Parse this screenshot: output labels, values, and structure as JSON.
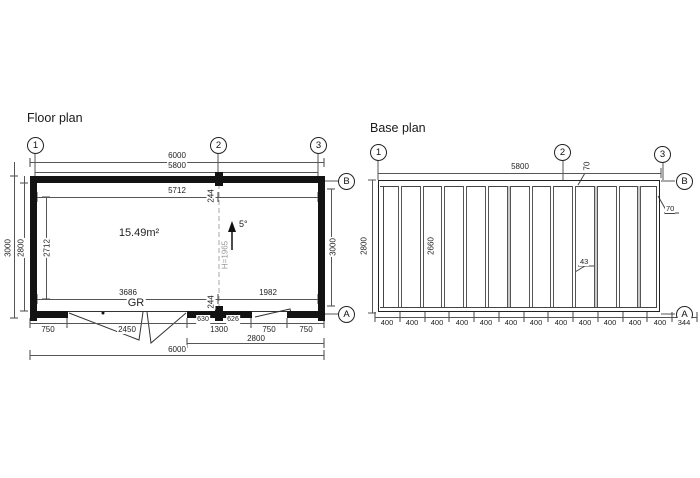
{
  "floor_plan": {
    "title": "Floor plan",
    "grid_labels": {
      "c1": "1",
      "c2": "2",
      "c3": "3",
      "rB": "B",
      "rA": "A"
    },
    "area": "15.49m²",
    "door_label": "GR",
    "roof_slope": "5°",
    "door_height": "H=1965",
    "dims": {
      "outer_width": "6000",
      "grid_width": "5800",
      "inner_width": "5712",
      "outer_height": "3000",
      "wall_height": "2800",
      "inner_height": "2712",
      "right_height": "3000",
      "partition_offset_top": "244",
      "partition_offset_bottom": "244",
      "inner_left": "3686",
      "inner_right": "1982",
      "door_left": "630",
      "door_right": "626",
      "bottom_segments": [
        "750",
        "2450",
        "1300",
        "750",
        "750"
      ],
      "bottom_2800": "2800",
      "bottom_total": "6000"
    }
  },
  "base_plan": {
    "title": "Base plan",
    "grid_labels": {
      "c1": "1",
      "c2": "2",
      "c3": "3",
      "rB": "B",
      "rA": "A"
    },
    "dims": {
      "width": "5800",
      "height": "2800",
      "joist_length": "2660",
      "rim_thickness_top": "70",
      "rim_thickness_right": "70",
      "joist_width": "43",
      "spacings": [
        "400",
        "400",
        "400",
        "400",
        "400",
        "400",
        "400",
        "400",
        "400",
        "400",
        "400",
        "400",
        "344"
      ]
    }
  }
}
